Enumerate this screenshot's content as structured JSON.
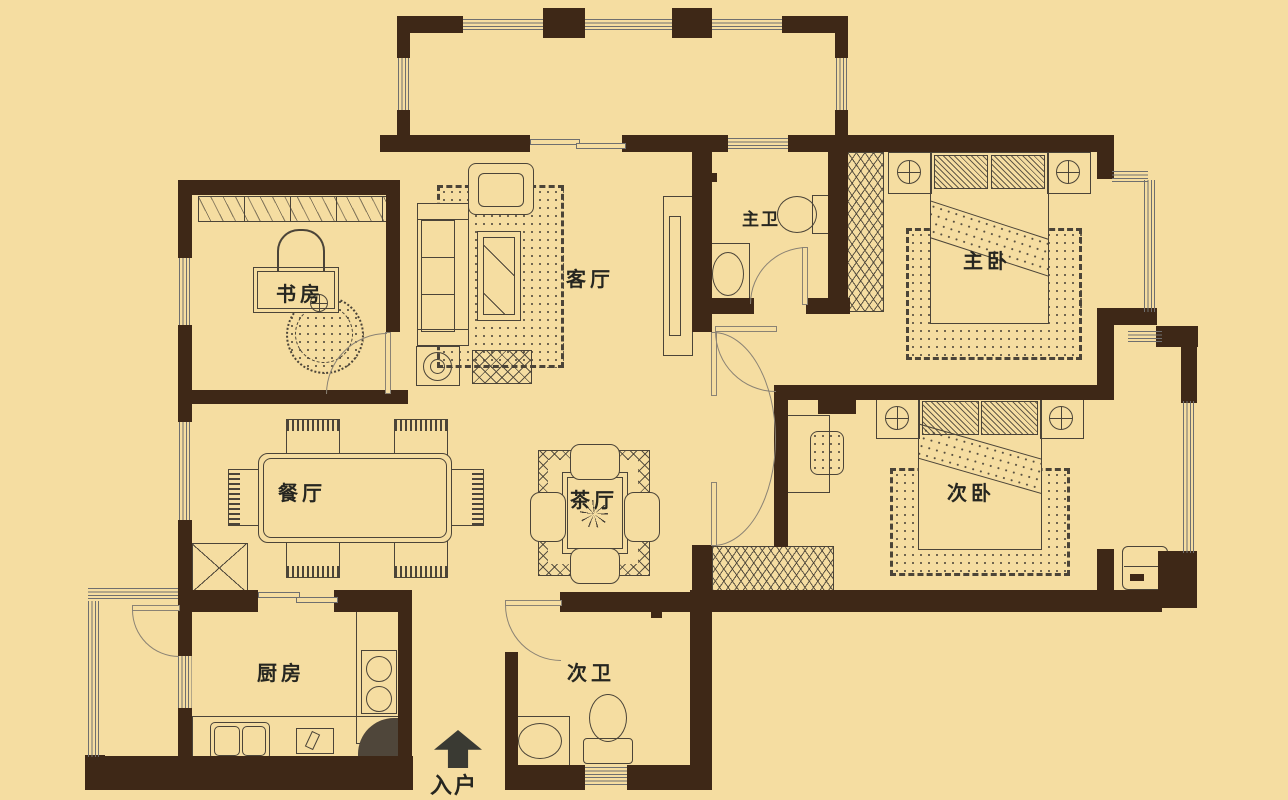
{
  "title": "apartment-floor-plan",
  "rooms": {
    "study": {
      "label": "书房"
    },
    "living": {
      "label": "客厅"
    },
    "master_bath": {
      "label": "主卫"
    },
    "master_bedroom": {
      "label": "主卧"
    },
    "dining": {
      "label": "餐厅"
    },
    "tea": {
      "label": "茶厅"
    },
    "second_bedroom": {
      "label": "次卧"
    },
    "kitchen": {
      "label": "厨房"
    },
    "second_bath": {
      "label": "次卫"
    },
    "entry": {
      "label": "入户",
      "arrow_icon": "up-arrow"
    }
  },
  "colors": {
    "background": "#f5dda1",
    "wall": "#3e2817",
    "furniture_line": "#4b4438",
    "window_line": "#6f6f6f",
    "door_line": "#8a8274"
  }
}
